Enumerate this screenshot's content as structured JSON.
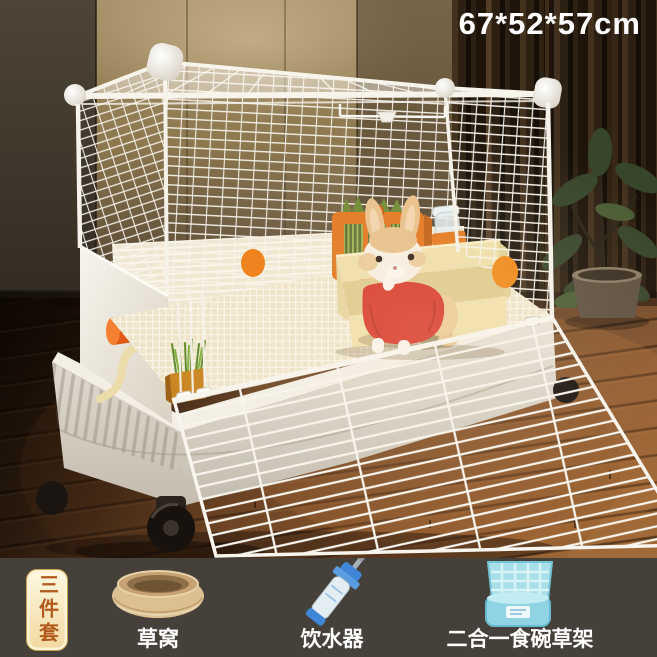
{
  "product_photo": {
    "dimensions_label": "67*52*57cm",
    "bundle_badge": "三件套",
    "items": [
      {
        "id": "grass-nest",
        "label": "草窝"
      },
      {
        "id": "water-dispenser",
        "label": "饮水器"
      },
      {
        "id": "food-bowl-hay-rack",
        "label": "二合一食碗草架"
      }
    ]
  },
  "colors": {
    "accent_orange": "#ee7c12",
    "sweater_red": "#d8382a",
    "cage_white": "#f7f4ec",
    "base_cream": "#e7e2d7",
    "litter_box_cream": "#eedfab",
    "bar_background": "#46403a",
    "badge_text": "#b2591b",
    "rack_blue": "#a9dfeb",
    "bottle_blue": "#3f87d6"
  }
}
